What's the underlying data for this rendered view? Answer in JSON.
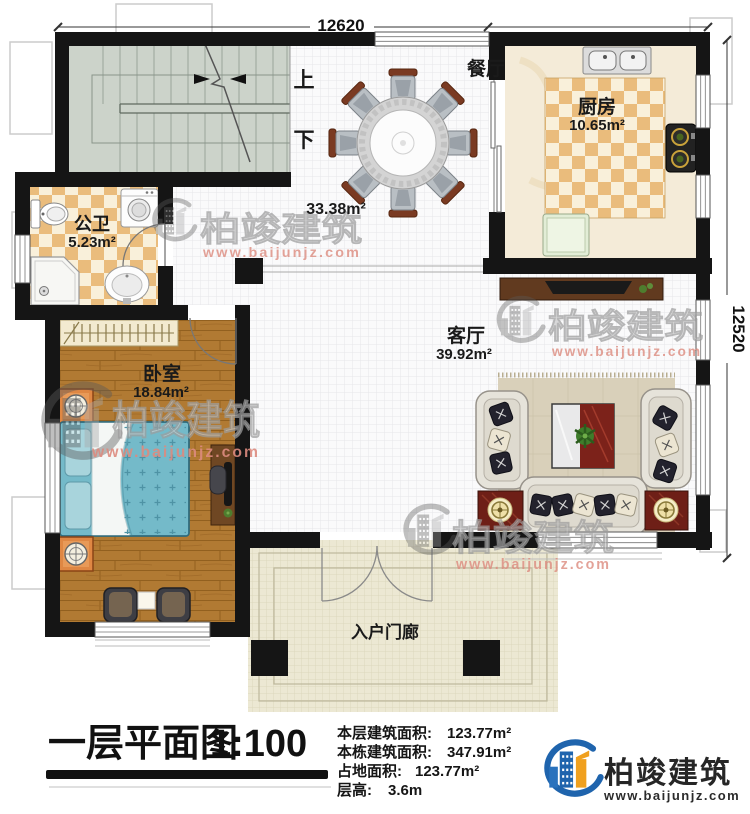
{
  "plan": {
    "dim_top": "12620",
    "dim_right": "12520",
    "stair_up": "上",
    "stair_down": "下",
    "hall_area": "33.38m²",
    "rooms": {
      "dining": {
        "label": "餐厅"
      },
      "kitchen": {
        "label": "厨房",
        "area": "10.65m²"
      },
      "bath": {
        "label": "公卫",
        "area": "5.23m²"
      },
      "bedroom": {
        "label": "卧室",
        "area": "18.84m²"
      },
      "living": {
        "label": "客厅",
        "area": "39.92m²"
      },
      "porch": {
        "label": "入户门廊"
      }
    }
  },
  "watermark": {
    "text": "柏竣建筑",
    "url": "www.baijunjz.com"
  },
  "footer": {
    "title": "一层平面图",
    "scale": "1:100",
    "stats": [
      {
        "label": "本层建筑面积:",
        "value": "123.77m²"
      },
      {
        "label": "本栋建筑面积:",
        "value": "347.91m²"
      },
      {
        "label": "占地面积:",
        "value": "123.77m²"
      },
      {
        "label": "层高:",
        "value": "3.6m"
      }
    ],
    "brand_name": "柏竣建筑",
    "brand_url": "www.baijunjz.com"
  },
  "colors": {
    "wall": "#151515",
    "checker_tile": "#eabc7c",
    "wood_floor": "#b17a33",
    "stair_floor": "#ccd3ca",
    "porch_floor": "#ece8d3",
    "brand_blue": "#1f64ad",
    "brand_orange": "#f0a01e",
    "watermark_red": "#dd8b7f"
  }
}
